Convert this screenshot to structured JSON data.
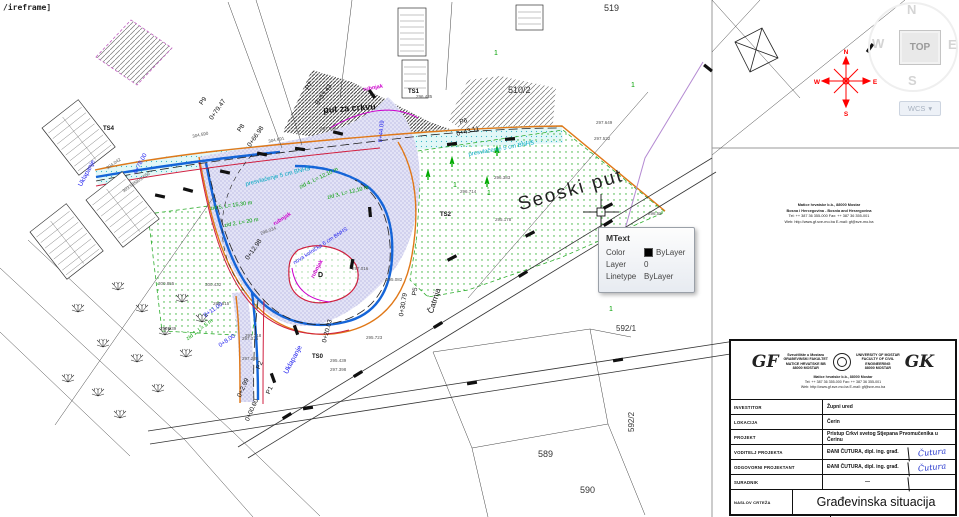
{
  "command_text": "/ireframe]",
  "tooltip": {
    "title": "MText",
    "color_label": "Color",
    "color_value": "ByLayer",
    "layer_label": "Layer",
    "layer_value": "0",
    "linetype_label": "Linetype",
    "linetype_value": "ByLayer"
  },
  "viewcube": {
    "north": "N",
    "west": "W",
    "south": "S",
    "east": "E",
    "top_face": "TOP",
    "wcs_label": "WCS",
    "wcs_caret": "▾"
  },
  "compass": {
    "n": "N",
    "w": "W",
    "e": "E",
    "s": "S",
    "color": "#ff0000"
  },
  "titleblock": {
    "logo_left": "GF",
    "logo_right": "GK",
    "inst_left": "Sveučilište u Mostaru\nGRAĐEVINSKI FAKULTET\nMATICE HRVATSKE BB\n88000 MOSTAR",
    "inst_right": "UNIVERSITY OF MOSTAR\nFACULTY OF CIVIL\nENGINEERING\n88000 MOSTAR",
    "addr_line1": "Matice hrvatske b.b., 88000 Mostar",
    "addr_line2": "Bosna i Hercegovina - Bosnia and Herzegovina",
    "addr_line3": "Tel: ++ 387 36 355-000    Fax: ++ 387 36 355-001",
    "addr_line4": "Web: http://www.gf.sve-mo.ba    E-mail: gf@sve-mo.ba",
    "rows": [
      {
        "label": "INVESTITOR",
        "value": "Župni ured"
      },
      {
        "label": "LOKACIJA",
        "value": "Čerin"
      },
      {
        "label": "PROJEKT",
        "value": "Pristup Crkvi svetog Stjepana Prvomučenika u Čerinu"
      },
      {
        "label": "VODITELJ PROJEKTA",
        "value": "ĐANI ČUTURA, dipl. ing. građ.",
        "sig": "Čutura"
      },
      {
        "label": "ODGOVORNI PROJEKTANT",
        "value": "ĐANI ČUTURA, dipl. ing. građ.",
        "sig": "Čutura"
      },
      {
        "label": "SURADNIK",
        "value": "—"
      },
      {
        "label": "NASLOV CRTEŽA",
        "value": "Građevinska situacija"
      },
      {
        "label": "RAZDOBLJE PROJEKTIRANJA",
        "value": "svibanj 2016. godine"
      }
    ]
  },
  "map": {
    "colors": {
      "blue_text": "#2222ee",
      "cyan_text": "#00a8c0",
      "green_text": "#00a000",
      "magenta_text": "#cc00cc",
      "black_text": "#111",
      "gray_text": "#555"
    },
    "labels": [
      {
        "t": "put za crkvu",
        "x": 323,
        "y": 106,
        "r": -4,
        "s": 9,
        "c": "#111",
        "b": 1,
        "n": "road-label-put-za-crkvu"
      },
      {
        "t": "Seoski put",
        "x": 516,
        "y": 196,
        "r": -16,
        "s": 19,
        "c": "#222",
        "ls": 2,
        "n": "road-label-seoski-put"
      },
      {
        "t": "Čatrnja",
        "x": 427,
        "y": 312,
        "r": -72,
        "s": 8,
        "c": "#111",
        "n": "road-label-catrnja"
      },
      {
        "t": "519",
        "x": 604,
        "y": 4,
        "s": 9,
        "c": "#333",
        "n": "parcel-519"
      },
      {
        "t": "510/2",
        "x": 508,
        "y": 86,
        "s": 9,
        "c": "#333",
        "n": "parcel-510-2"
      },
      {
        "t": "592/1",
        "x": 616,
        "y": 325,
        "s": 8,
        "c": "#333",
        "n": "parcel-592-1"
      },
      {
        "t": "592/2",
        "x": 628,
        "y": 432,
        "r": -90,
        "s": 8,
        "c": "#333",
        "n": "parcel-592-2"
      },
      {
        "t": "589",
        "x": 538,
        "y": 450,
        "s": 9,
        "c": "#333",
        "n": "parcel-589"
      },
      {
        "t": "590",
        "x": 580,
        "y": 486,
        "s": 9,
        "c": "#333",
        "n": "parcel-590"
      },
      {
        "t": "D",
        "x": 318,
        "y": 272,
        "s": 7,
        "c": "#111",
        "b": 1,
        "n": "point-D"
      },
      {
        "t": "TS0",
        "x": 312,
        "y": 354,
        "s": 6,
        "c": "#111",
        "b": 1,
        "n": "point-TS0"
      },
      {
        "t": "TS1",
        "x": 408,
        "y": 89,
        "s": 6,
        "c": "#111",
        "b": 1,
        "n": "point-TS1"
      },
      {
        "t": "TS2",
        "x": 440,
        "y": 212,
        "s": 6,
        "c": "#111",
        "b": 1,
        "n": "point-TS2"
      },
      {
        "t": "TS4",
        "x": 103,
        "y": 126,
        "s": 6,
        "c": "#111",
        "b": 1,
        "n": "point-TS4"
      },
      {
        "t": "P9",
        "x": 199,
        "y": 103,
        "r": -55,
        "s": 6.5,
        "c": "#111",
        "n": "station-P9"
      },
      {
        "t": "0+79.47",
        "x": 209,
        "y": 118,
        "r": -55,
        "s": 6.5,
        "c": "#111",
        "n": "station-P9-chainage"
      },
      {
        "t": "P8",
        "x": 237,
        "y": 130,
        "r": -55,
        "s": 6.5,
        "c": "#111",
        "n": "station-P8"
      },
      {
        "t": "0+66.98",
        "x": 247,
        "y": 145,
        "r": -55,
        "s": 6.5,
        "c": "#111",
        "n": "station-P8-chainage"
      },
      {
        "t": "P7",
        "x": 305,
        "y": 88,
        "r": -55,
        "s": 6.5,
        "c": "#111",
        "n": "station-P7"
      },
      {
        "t": "0+53.43",
        "x": 315,
        "y": 103,
        "r": -55,
        "s": 6.5,
        "c": "#111",
        "n": "station-P7-chainage"
      },
      {
        "t": "P6",
        "x": 459,
        "y": 120,
        "r": -14,
        "s": 6.5,
        "c": "#111",
        "n": "station-P6"
      },
      {
        "t": "0+43.11",
        "x": 456,
        "y": 132,
        "r": -14,
        "s": 6.5,
        "c": "#111",
        "n": "station-P6-chainage"
      },
      {
        "t": "P5",
        "x": 412,
        "y": 295,
        "r": -80,
        "s": 6.5,
        "c": "#111",
        "n": "station-P5"
      },
      {
        "t": "0+30.79",
        "x": 399,
        "y": 316,
        "r": -80,
        "s": 6.5,
        "c": "#111",
        "n": "station-P5-chainage"
      },
      {
        "t": "0+20.03",
        "x": 322,
        "y": 342,
        "r": -75,
        "s": 6.5,
        "c": "#111",
        "n": "station-chainage-20"
      },
      {
        "t": "0+12.98",
        "x": 245,
        "y": 258,
        "r": -55,
        "s": 6.5,
        "c": "#111",
        "n": "station-chainage-12"
      },
      {
        "t": "P2",
        "x": 256,
        "y": 368,
        "r": -66,
        "s": 6.5,
        "c": "#111",
        "n": "station-P2"
      },
      {
        "t": "0+2.99",
        "x": 237,
        "y": 396,
        "r": -66,
        "s": 6.5,
        "c": "#111",
        "n": "station-P2-chainage"
      },
      {
        "t": "P1",
        "x": 266,
        "y": 393,
        "r": -66,
        "s": 6.5,
        "c": "#111",
        "n": "station-P1"
      },
      {
        "t": "0+00.00",
        "x": 245,
        "y": 420,
        "r": -66,
        "s": 6.5,
        "c": "#111",
        "n": "station-P1-chainage"
      },
      {
        "t": "Uklapanje",
        "x": 78,
        "y": 185,
        "r": -62,
        "s": 6.5,
        "c": "#2222ee",
        "n": "note-uklapanje-1"
      },
      {
        "t": "0+78.00",
        "x": 133,
        "y": 172,
        "r": -62,
        "s": 6,
        "c": "#2222ee",
        "n": "note-chainage-78"
      },
      {
        "t": "Uklapanje",
        "x": 283,
        "y": 372,
        "r": -62,
        "s": 7,
        "c": "#2222ee",
        "n": "note-uklapanje-2"
      },
      {
        "t": "0+11.00",
        "x": 203,
        "y": 314,
        "r": -35,
        "s": 6,
        "c": "#2222ee",
        "n": "note-chainage-11"
      },
      {
        "t": "0+8.00",
        "x": 218,
        "y": 344,
        "r": -35,
        "s": 6,
        "c": "#2222ee",
        "n": "note-chainage-8"
      },
      {
        "t": "0+44.09",
        "x": 378,
        "y": 142,
        "r": -85,
        "s": 6,
        "c": "#2222ee",
        "n": "note-chainage-44"
      },
      {
        "t": "nova kolnička 6 cm BNHS",
        "x": 293,
        "y": 262,
        "r": -33,
        "s": 5.5,
        "c": "#2222ee",
        "n": "note-nova-kolnicka"
      },
      {
        "t": "presvlačenje 5 cm BNHS",
        "x": 245,
        "y": 182,
        "r": -14,
        "s": 6,
        "c": "#00a8c0",
        "n": "note-presvlacenje-1"
      },
      {
        "t": "presvlačenje 5 cm BNHS",
        "x": 468,
        "y": 152,
        "r": -10,
        "s": 6,
        "c": "#00a8c0",
        "n": "note-presvlacenje-2"
      },
      {
        "t": "zid 1, L= 5 m",
        "x": 186,
        "y": 338,
        "r": -37,
        "s": 5.5,
        "c": "#00a000",
        "n": "note-zid-1"
      },
      {
        "t": "zid 2, L= 20 m",
        "x": 224,
        "y": 224,
        "r": -10,
        "s": 5.5,
        "c": "#00a000",
        "n": "note-zid-2"
      },
      {
        "t": "zid 5, L= 15,30 m",
        "x": 210,
        "y": 207,
        "r": -8,
        "s": 5.5,
        "c": "#00a000",
        "n": "note-zid-5"
      },
      {
        "t": "zid 4, L= 12,10 m",
        "x": 299,
        "y": 186,
        "r": -26,
        "s": 5.5,
        "c": "#00a000",
        "n": "note-zid-4"
      },
      {
        "t": "zid 3, L= 12,10 m",
        "x": 327,
        "y": 196,
        "r": -14,
        "s": 5.5,
        "c": "#00a000",
        "n": "note-zid-3"
      },
      {
        "t": "rubnjak",
        "x": 363,
        "y": 88,
        "r": -10,
        "s": 5.5,
        "c": "#cc00cc",
        "b": 1,
        "n": "note-rubnjak-1"
      },
      {
        "t": "rubnjak",
        "x": 273,
        "y": 223,
        "r": -33,
        "s": 5.5,
        "c": "#cc00cc",
        "b": 1,
        "n": "note-rubnjak-2"
      },
      {
        "t": "rubnjak",
        "x": 311,
        "y": 277,
        "r": -62,
        "s": 5.5,
        "c": "#cc00cc",
        "b": 1,
        "n": "note-rubnjak-3"
      },
      {
        "t": "1",
        "x": 494,
        "y": 50,
        "s": 7,
        "c": "#00a000",
        "n": "point-num"
      },
      {
        "t": "1",
        "x": 631,
        "y": 82,
        "s": 7,
        "c": "#00a000",
        "n": "point-num"
      },
      {
        "t": "1",
        "x": 453,
        "y": 182,
        "s": 7,
        "c": "#00a000",
        "n": "point-num"
      },
      {
        "t": "1",
        "x": 487,
        "y": 190,
        "s": 7,
        "c": "#00a000",
        "n": "point-num"
      },
      {
        "t": "1",
        "x": 609,
        "y": 306,
        "s": 7,
        "c": "#00a000",
        "n": "point-num"
      },
      {
        "t": "1",
        "x": 683,
        "y": 257,
        "s": 7,
        "c": "#00a000",
        "n": "point-num"
      },
      {
        "t": "1",
        "x": 644,
        "y": 286,
        "s": 7,
        "c": "#00a000",
        "n": "point-num"
      },
      {
        "t": "304.590",
        "x": 192,
        "y": 135,
        "r": -12,
        "s": 4.5,
        "c": "#555",
        "n": "elev"
      },
      {
        "t": "304.691",
        "x": 268,
        "y": 140,
        "r": -12,
        "s": 4.5,
        "c": "#555",
        "n": "elev"
      },
      {
        "t": "297.896",
        "x": 320,
        "y": 127,
        "s": 4.5,
        "c": "#555",
        "n": "elev"
      },
      {
        "t": "296.435",
        "x": 416,
        "y": 95,
        "s": 4.5,
        "c": "#555",
        "n": "elev"
      },
      {
        "t": "297.649",
        "x": 596,
        "y": 121,
        "s": 4.5,
        "c": "#555",
        "n": "elev"
      },
      {
        "t": "297.532",
        "x": 594,
        "y": 137,
        "s": 4.5,
        "c": "#555",
        "n": "elev"
      },
      {
        "t": "296.55",
        "x": 648,
        "y": 212,
        "s": 4.5,
        "c": "#555",
        "n": "elev"
      },
      {
        "t": "297.016",
        "x": 352,
        "y": 267,
        "s": 4.5,
        "c": "#555",
        "n": "elev"
      },
      {
        "t": "295.082",
        "x": 386,
        "y": 278,
        "s": 4.5,
        "c": "#555",
        "n": "elev"
      },
      {
        "t": "295.723",
        "x": 366,
        "y": 336,
        "s": 4.5,
        "c": "#555",
        "n": "elev"
      },
      {
        "t": "295.439",
        "x": 330,
        "y": 359,
        "s": 4.5,
        "c": "#555",
        "n": "elev"
      },
      {
        "t": "297.398",
        "x": 330,
        "y": 368,
        "s": 4.5,
        "c": "#555",
        "n": "elev"
      },
      {
        "t": "297.318",
        "x": 245,
        "y": 334,
        "s": 4.5,
        "c": "#555",
        "n": "elev"
      },
      {
        "t": "297.288",
        "x": 242,
        "y": 357,
        "s": 4.5,
        "c": "#555",
        "n": "elev"
      },
      {
        "t": "300.855",
        "x": 158,
        "y": 282,
        "s": 4.5,
        "c": "#555",
        "n": "elev"
      },
      {
        "t": "300.432",
        "x": 205,
        "y": 283,
        "s": 4.5,
        "c": "#555",
        "n": "elev"
      },
      {
        "t": "299.815",
        "x": 213,
        "y": 302,
        "s": 4.5,
        "c": "#555",
        "n": "elev"
      },
      {
        "t": "299.839",
        "x": 160,
        "y": 327,
        "s": 4.5,
        "c": "#555",
        "n": "elev"
      },
      {
        "t": "297.315",
        "x": 242,
        "y": 337,
        "s": 4.5,
        "c": "#555",
        "n": "elev"
      },
      {
        "t": "296.714",
        "x": 460,
        "y": 190,
        "s": 4.5,
        "c": "#555",
        "n": "elev"
      },
      {
        "t": "296.383",
        "x": 494,
        "y": 176,
        "s": 4.5,
        "c": "#555",
        "n": "elev"
      },
      {
        "t": "295.178",
        "x": 495,
        "y": 218,
        "s": 4.5,
        "c": "#555",
        "n": "elev"
      },
      {
        "t": "304.042",
        "x": 106,
        "y": 167,
        "r": -35,
        "s": 4.5,
        "c": "#555",
        "n": "elev"
      },
      {
        "t": "303.650",
        "x": 135,
        "y": 181,
        "r": -35,
        "s": 4.5,
        "c": "#555",
        "n": "elev"
      },
      {
        "t": "303.595",
        "x": 122,
        "y": 190,
        "r": -35,
        "s": 4.5,
        "c": "#555",
        "n": "elev"
      },
      {
        "t": "298.034",
        "x": 260,
        "y": 232,
        "r": -20,
        "s": 4.5,
        "c": "#555",
        "n": "elev"
      }
    ]
  }
}
